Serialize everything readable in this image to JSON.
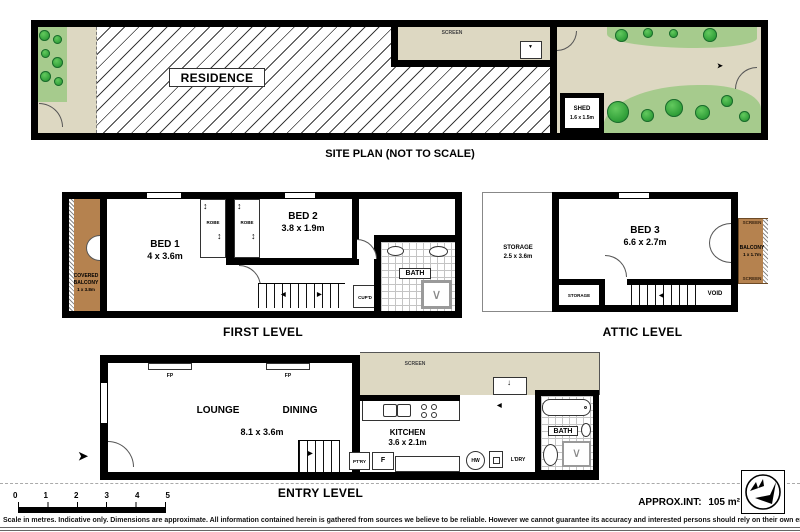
{
  "site_plan": {
    "title": "SITE PLAN (NOT TO SCALE)",
    "residence": "RESIDENCE",
    "screen": "SCREEN",
    "shed": "SHED",
    "shed_size": "1.6 x 1.5m"
  },
  "first_level": {
    "title": "FIRST LEVEL",
    "bed1": "BED 1",
    "bed1_size": "4 x 3.6m",
    "bed2": "BED 2",
    "bed2_size": "3.8 x 1.9m",
    "robe": "ROBE",
    "bath": "BATH",
    "cupboard": "CUP'D",
    "balcony_line1": "COVERED",
    "balcony_line2": "BALCONY",
    "balcony_size": "1 x 3.8m"
  },
  "attic_level": {
    "title": "ATTIC LEVEL",
    "storage_main": "STORAGE",
    "storage_main_size": "2.5 x 3.6m",
    "bed3": "BED 3",
    "bed3_size": "6.6 x 2.7m",
    "balcony": "BALCONY",
    "balcony_size": "1 x 1.7m",
    "screen": "SCREEN",
    "storage_small": "STORAGE",
    "void": "VOID"
  },
  "entry_level": {
    "title": "ENTRY LEVEL",
    "lounge": "LOUNGE",
    "dining": "DINING",
    "size": "8.1 x 3.6m",
    "fp": "FP",
    "screen": "SCREEN",
    "kitchen": "KITCHEN",
    "kitchen_size": "3.6 x 2.1m",
    "pantry": "PT'RY",
    "fridge": "F",
    "hot_water": "HW",
    "laundry": "L'DRY",
    "bath": "BATH"
  },
  "footer": {
    "scale_ticks": [
      "0",
      "1",
      "2",
      "3",
      "4",
      "5"
    ],
    "approx_label": "APPROX.INT:",
    "approx_area": "105 m²",
    "disclaimer": "Scale in metres. Indicative only. Dimensions are approximate. All information contained herein is gathered from sources we believe to be reliable. However we cannot guarantee its accuracy and interested persons should rely on their own enquiries"
  },
  "colors": {
    "wall": "#000000",
    "courtyard": "#ddd8c2",
    "garden": "#a6cb8d",
    "bush": "#2f9e38",
    "balcony": "#b5824f"
  }
}
